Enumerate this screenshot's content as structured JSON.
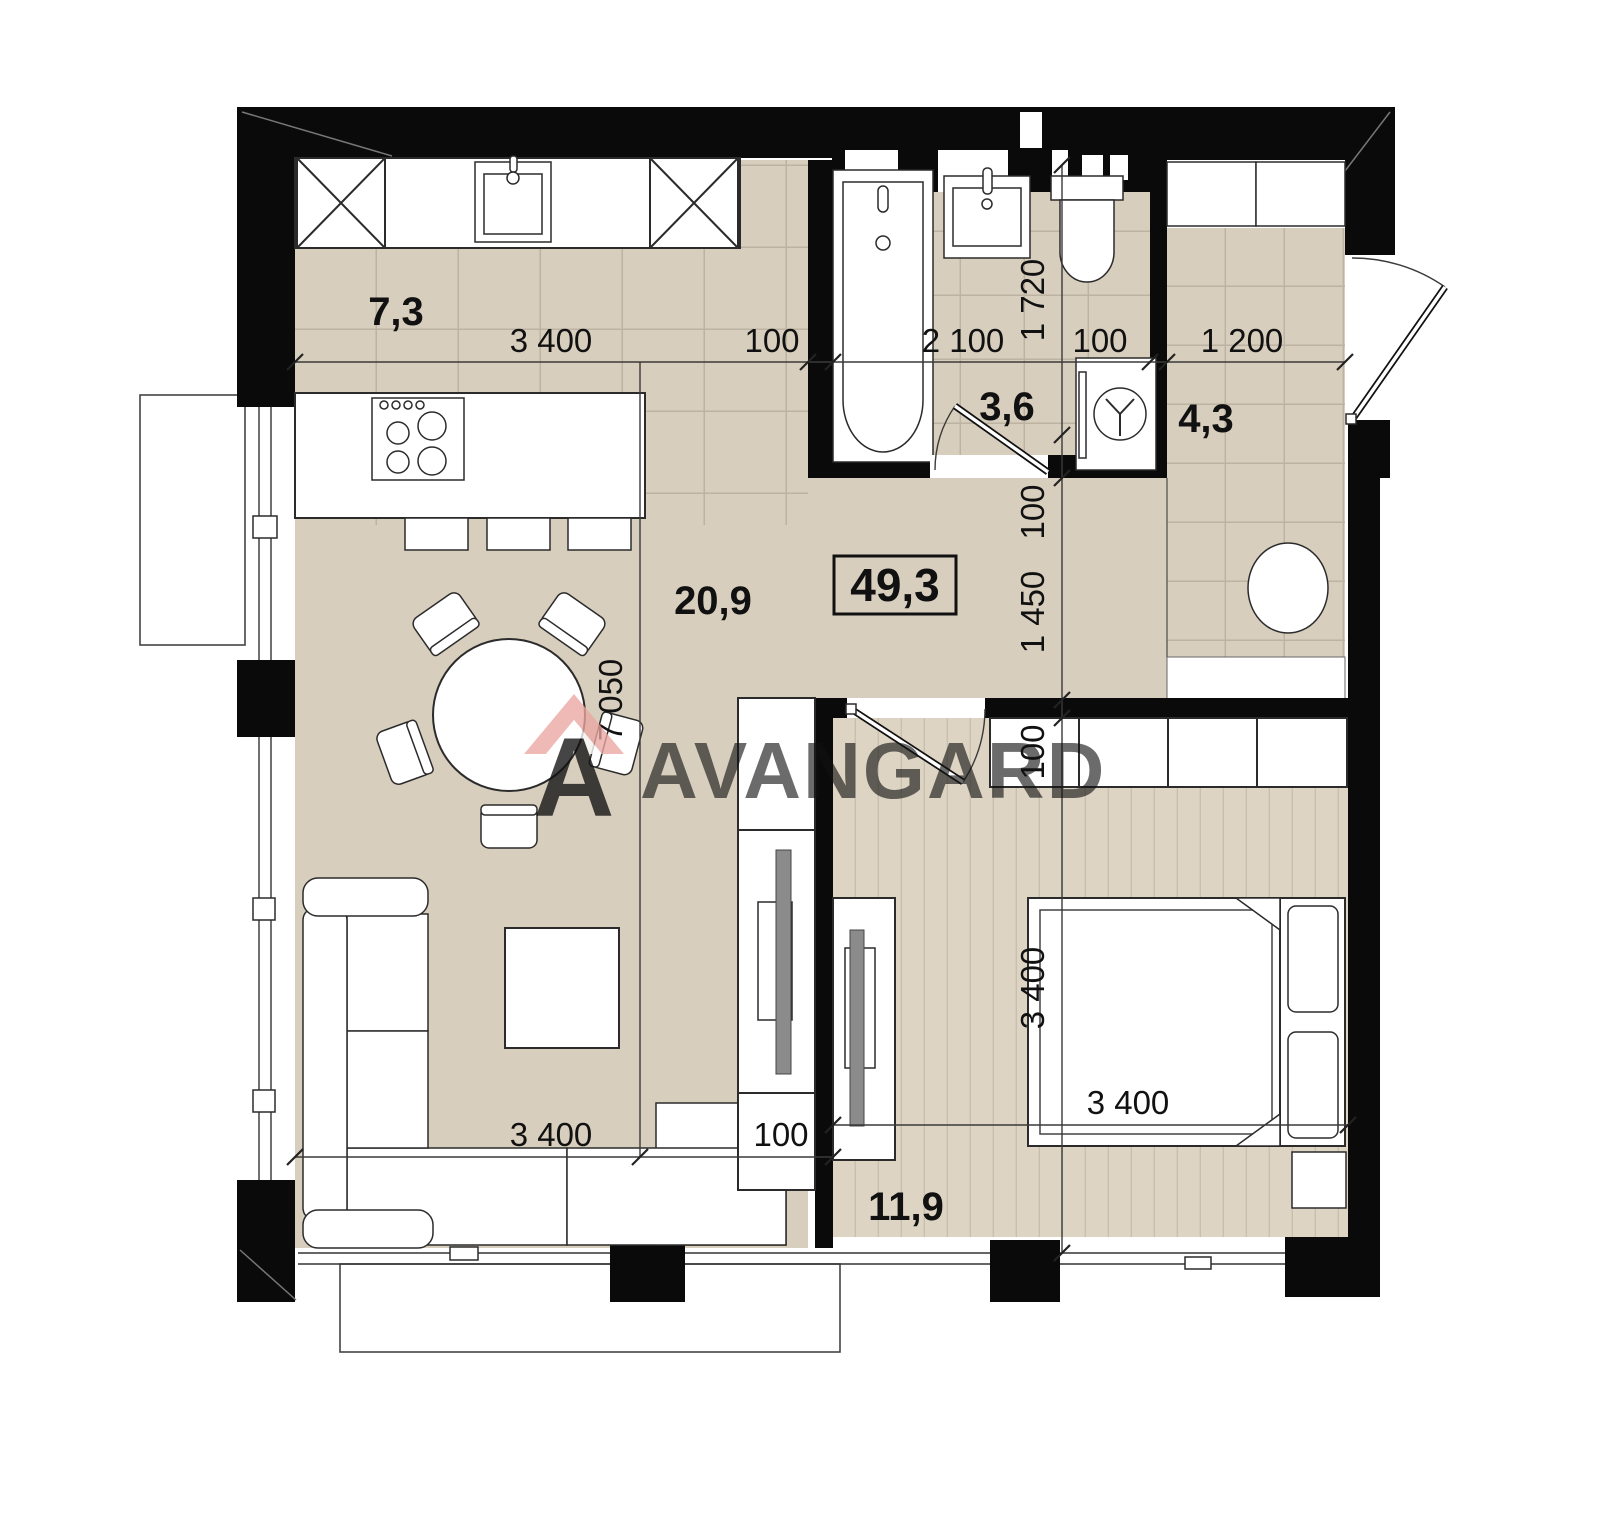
{
  "plan": {
    "type": "apartment-floor-plan",
    "watermark": {
      "brand": "AVANGARD",
      "logo_letter": "A"
    },
    "labels": {
      "kitchen_area": "7,3",
      "bathroom_area": "3,6",
      "hallway_area": "4,3",
      "living_area": "20,9",
      "bedroom_area": "11,9",
      "total_area": "49,3",
      "dim_kitchen_width": "3 400",
      "dim_wall_1": "100",
      "dim_bath_width": "2 100",
      "dim_wall_2": "100",
      "dim_hall_width": "1 200",
      "dim_bath_height": "1 720",
      "dim_wall_3": "100",
      "dim_corridor": "1 450",
      "dim_total_height": "7 050",
      "dim_wall_4": "100",
      "dim_bedroom_height": "3 400",
      "dim_living_width": "3 400",
      "dim_wall_5": "100",
      "dim_bedroom_width": "3 400"
    },
    "colors": {
      "floor_tile": "#d8cebd",
      "floor_plank": "#ded4c3",
      "tile_grid_line": "#bcb3a2",
      "plank_line": "#c9bfaf",
      "wall": "#0a0a0a",
      "furniture_stroke": "#2b2b2b",
      "dimension_text": "#111111",
      "watermark_gray": "#96a1ab",
      "logo_red": "#c4463e",
      "logo_pink": "#eba7a2"
    },
    "rooms": [
      {
        "name": "kitchen",
        "area": "7,3",
        "floor": "tile"
      },
      {
        "name": "living-dining",
        "area": "20,9",
        "floor": "plain"
      },
      {
        "name": "bathroom",
        "area": "3,6",
        "floor": "tile"
      },
      {
        "name": "hallway",
        "area": "4,3",
        "floor": "tile"
      },
      {
        "name": "bedroom",
        "area": "11,9",
        "floor": "plank"
      }
    ]
  }
}
